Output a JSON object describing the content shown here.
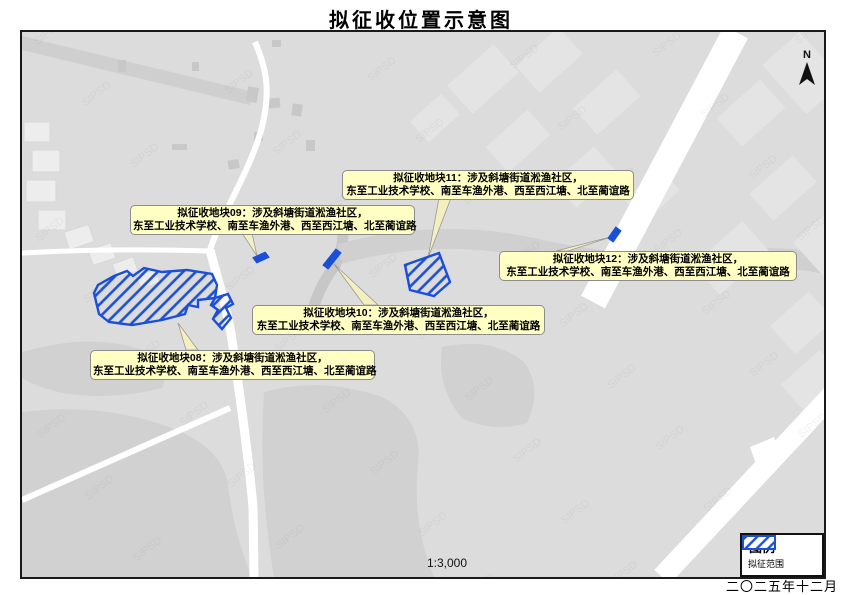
{
  "title": "拟征收位置示意图",
  "map": {
    "watermark": "SIPSD",
    "north_label": "N",
    "scale_text": "1:3,000"
  },
  "plots": {
    "labels": [
      {
        "id": "08",
        "line1": "拟征收地块08：涉及斜塘街道淞渔社区，",
        "line2": "东至工业技术学校、南至车渔外港、西至西江塘、北至蔺谊路"
      },
      {
        "id": "09",
        "line1": "拟征收地块09：涉及斜塘街道淞渔社区，",
        "line2": "东至工业技术学校、南至车渔外港、西至西江塘、北至蔺谊路"
      },
      {
        "id": "10",
        "line1": "拟征收地块10：涉及斜塘街道淞渔社区，",
        "line2": "东至工业技术学校、南至车渔外港、西至西江塘、北至蔺谊路"
      },
      {
        "id": "11",
        "line1": "拟征收地块11：涉及斜塘街道淞渔社区，",
        "line2": "东至工业技术学校、南至车渔外港、西至西江塘、北至蔺谊路"
      },
      {
        "id": "12",
        "line1": "拟征收地块12：涉及斜塘街道淞渔社区，",
        "line2": "东至工业技术学校、南至车渔外港、西至西江塘、北至蔺谊路"
      }
    ]
  },
  "legend": {
    "title": "图例",
    "item_label": "拟征范围"
  },
  "footer": {
    "date": "二〇二五年十二月"
  },
  "colors": {
    "plot_blue": "#1b4fd8",
    "label_bg": "#ffffc4",
    "map_bg": "#dcdcdc",
    "road": "#ffffff"
  }
}
